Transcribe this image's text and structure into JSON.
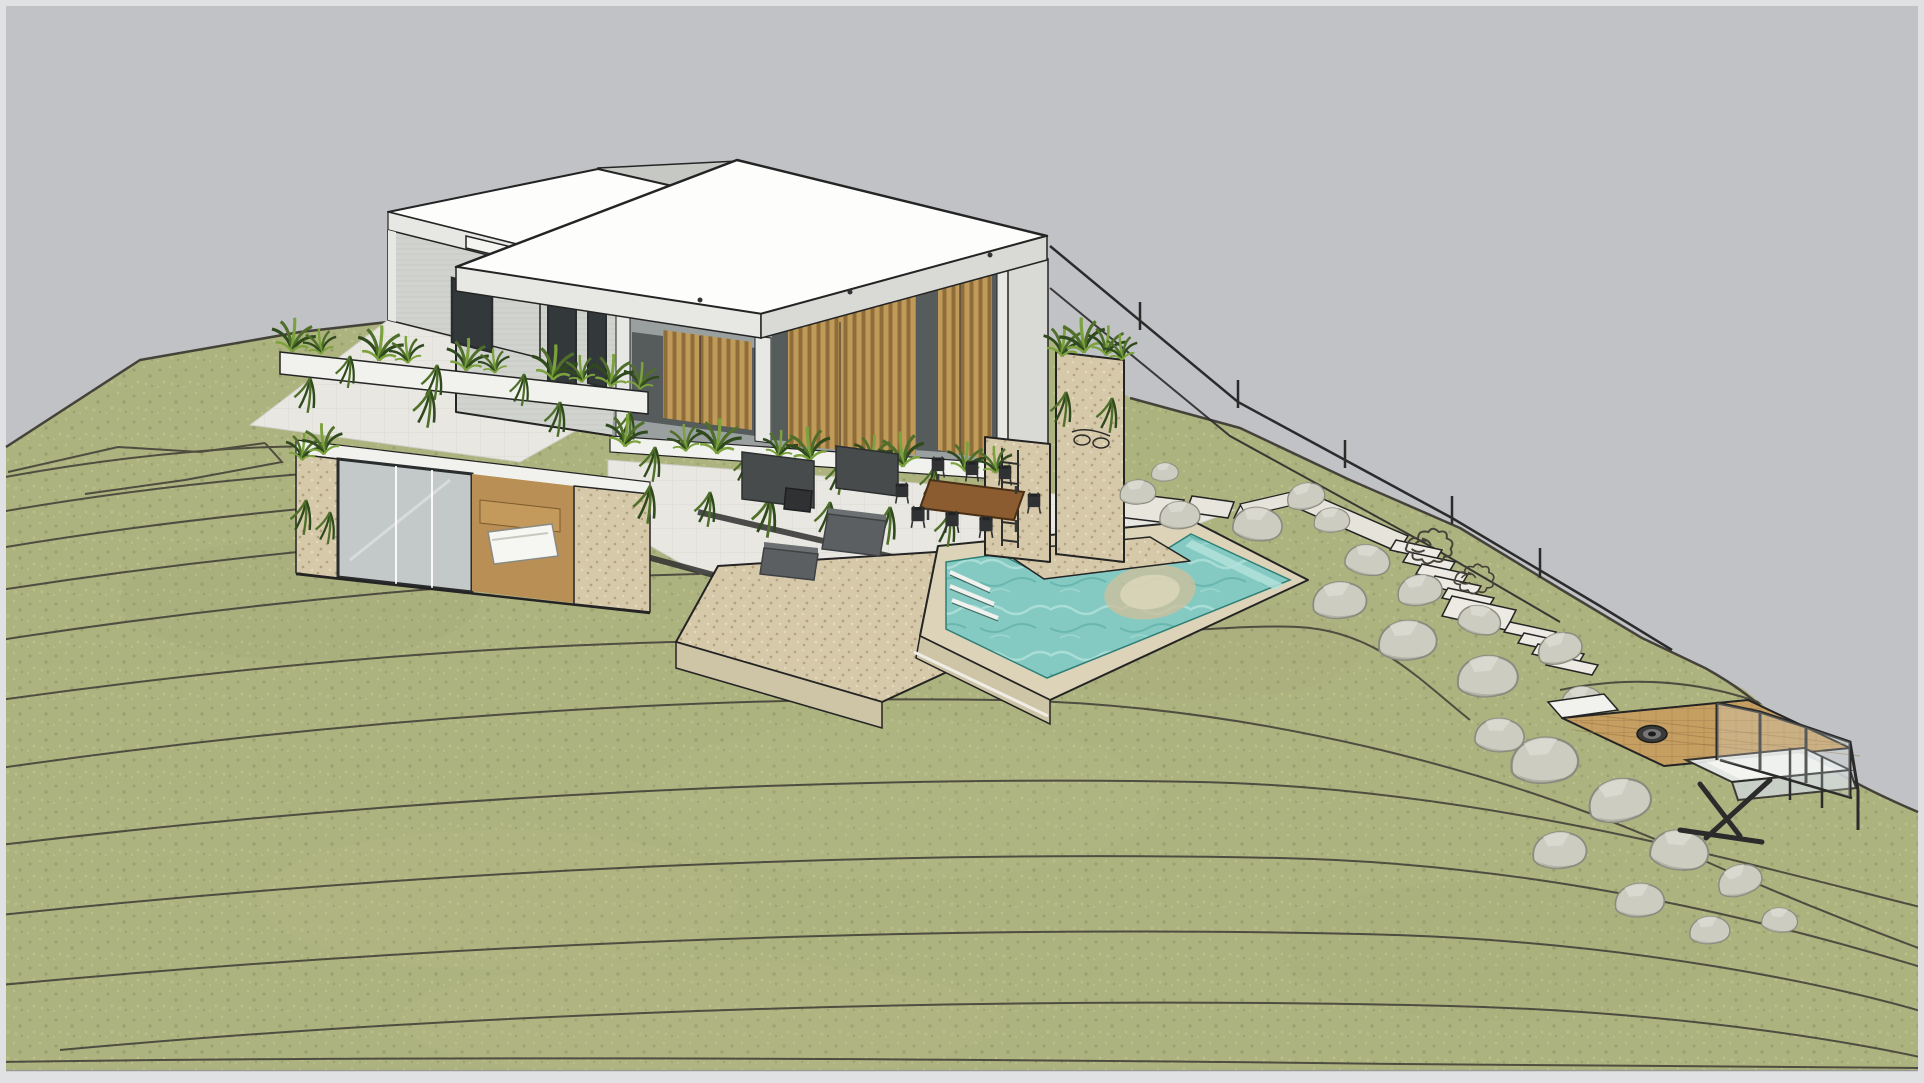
{
  "viewport": {
    "width": 1924,
    "height": 1083,
    "kind": "3d-architectural-model-render",
    "scene_label": "hillside-villa-with-pool-and-viewing-deck"
  },
  "palette": {
    "frame": "#e0e1e3",
    "sky": "#c0c2c5",
    "grass": "#adb37f",
    "grassLight": "#bcc18c",
    "grassDark": "#9aa171",
    "contour": "#45423a",
    "line": "#242424",
    "roof": "#fdfdfc",
    "fasciaLight": "#e7e8e4",
    "fasciaDark": "#d9dad6",
    "wall": "#d1d3cf",
    "wallLine": "#bfc1bd",
    "wallShade": "#c6c8c4",
    "whiteSlab": "#f1f2ee",
    "glass": "#c3c9c9",
    "glassDark": "#565b5b",
    "frameDark": "#2a2d2e",
    "slat": "#c09a58",
    "slatDark": "#8f6d3a",
    "stone": "#d6c9a9",
    "stoneDot": "#b3a27f",
    "stoneLight": "#e8ddc3",
    "stoneFace": "#cec4a6",
    "coping": "#ddd3b8",
    "pave": "#e8e7e1",
    "paveLine": "#cfcec6",
    "water": "#85cac2",
    "waterLight": "#b2e2db",
    "waterDark": "#57aaa2",
    "poolSand": "#cbbf9e",
    "deckWood": "#c59e62",
    "deckLine": "#93713f",
    "rock": "#cdccc1",
    "rockLight": "#deded4",
    "rockShade": "#a9a99d",
    "rockEdge": "#8b8b80",
    "plantDark": "#2f4a1d",
    "plantMid": "#4f6f2a",
    "plantLight": "#7ba23c",
    "furn": "#2f3133",
    "sofa": "#5c5f62",
    "sofaLight": "#6d7073",
    "tableWood": "#8a5c30",
    "railing": "#2b2b2b"
  },
  "scene": {
    "sky": "overcast-gray",
    "terrain": "terraced-hillside-with-contour-lines",
    "objects": [
      "flat-roof-villa",
      "wood-slat-veranda",
      "roof-terrace",
      "planter-parapets",
      "stone-pillars",
      "outdoor-dining-set",
      "lounge-sofas",
      "l-shaped-pool",
      "pool-steps",
      "submerged-rock",
      "stone-sun-deck",
      "stepping-stones",
      "boulder-garden",
      "hillside-stairs",
      "wire-fence",
      "cantilevered-viewing-deck",
      "glass-railing",
      "fire-pit",
      "sunken-lounge"
    ]
  }
}
